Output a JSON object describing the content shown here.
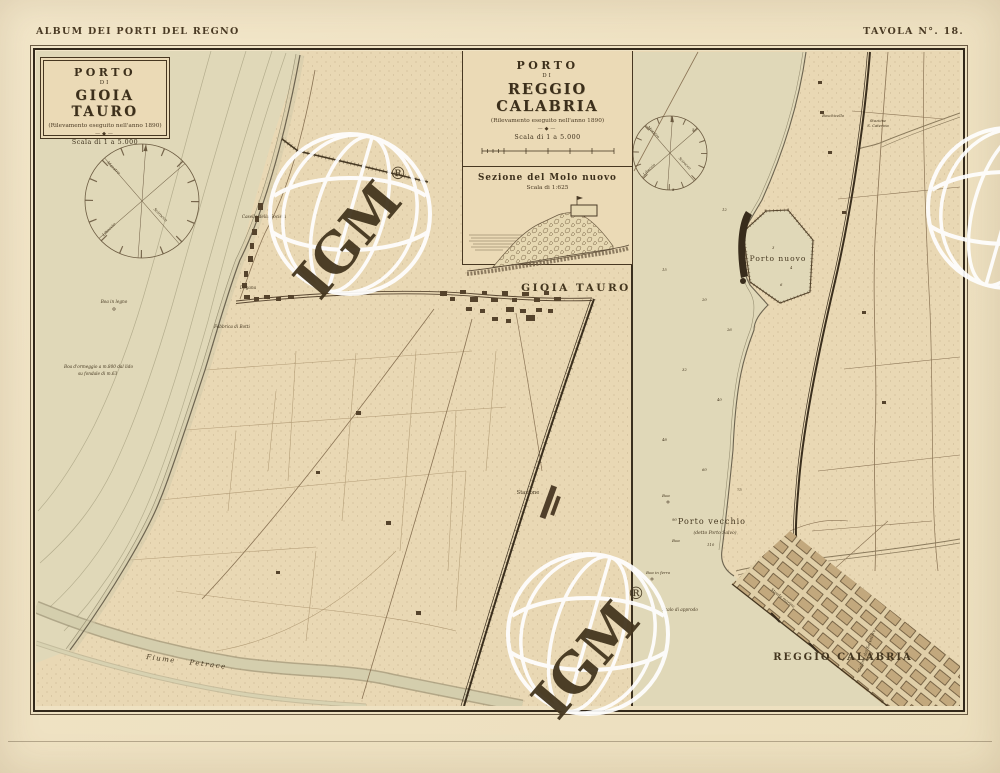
{
  "page": {
    "header_left": "ALBUM DEI PORTI DEL REGNO",
    "header_right": "TAVOLA N°. 18."
  },
  "gioia": {
    "box_title": "PORTO",
    "box_di": "DI",
    "box_name": "GIOIA TAURO",
    "survey_note": "(Rilevamento eseguito nell'anno 1890)",
    "ornament": "—◆—",
    "scale_note": "Scala di 1 a 5.000",
    "town_label": "GIOIA TAURO",
    "station_label": "Stazione",
    "river_label": "Fiume  Petrace",
    "casello_label": "Casello della Società",
    "dogana_label": "Dogana",
    "fabbrica_label": "Fabbrica di Botti",
    "buoy_label": "Boa in legno",
    "mooring_line1": "Boa d'ormeggio a m.800 dal lido",
    "mooring_line2": "su fondale di m.63",
    "compass": {
      "nw": "Maestro",
      "sw": "Libeccio",
      "se": "Scirocco"
    }
  },
  "reggio": {
    "box_title": "PORTO",
    "box_di": "DI",
    "box_name": "REGGIO CALABRIA",
    "survey_note": "(Rilevamento eseguito nell'anno 1890)",
    "ornament": "—◆—",
    "scale_note": "Scala di 1 a 5.000",
    "section_title": "Sezione del Molo nuovo",
    "section_scale": "Scala di 1:625",
    "porto_nuovo_label": "Porto nuovo",
    "porto_vecchio_label": "Porto vecchio",
    "porto_vecchio_sub": "(detto Porto Salvo)",
    "city_label": "REGGIO CALABRIA",
    "hill_label": "Collina del Salvatore",
    "station_line1": "Stazione",
    "station_line2": "S. Caterina",
    "villa_label": "Boschicello",
    "buoy_iron_label": "Boa in ferro",
    "buoy_label": "Boa",
    "scalo_label": "Scalo di approdo",
    "marina_label": "Strada marina",
    "soundings": [
      "5",
      "8",
      "12",
      "15",
      "20",
      "26",
      "32",
      "40",
      "48",
      "60",
      "75",
      "90",
      "110",
      "3",
      "4",
      "6"
    ],
    "compass": {
      "nw": "Maestro",
      "sw": "Libeccio",
      "se": "Scirocco"
    }
  },
  "watermark": {
    "text": "IGM",
    "registered": "®"
  },
  "colors": {
    "paper": "#e9d8b4",
    "margin": "#efe2c3",
    "ink": "#3c2f1b",
    "line": "#8a7354",
    "sea": "#e0d8b8",
    "river": "#cdc7a6"
  }
}
